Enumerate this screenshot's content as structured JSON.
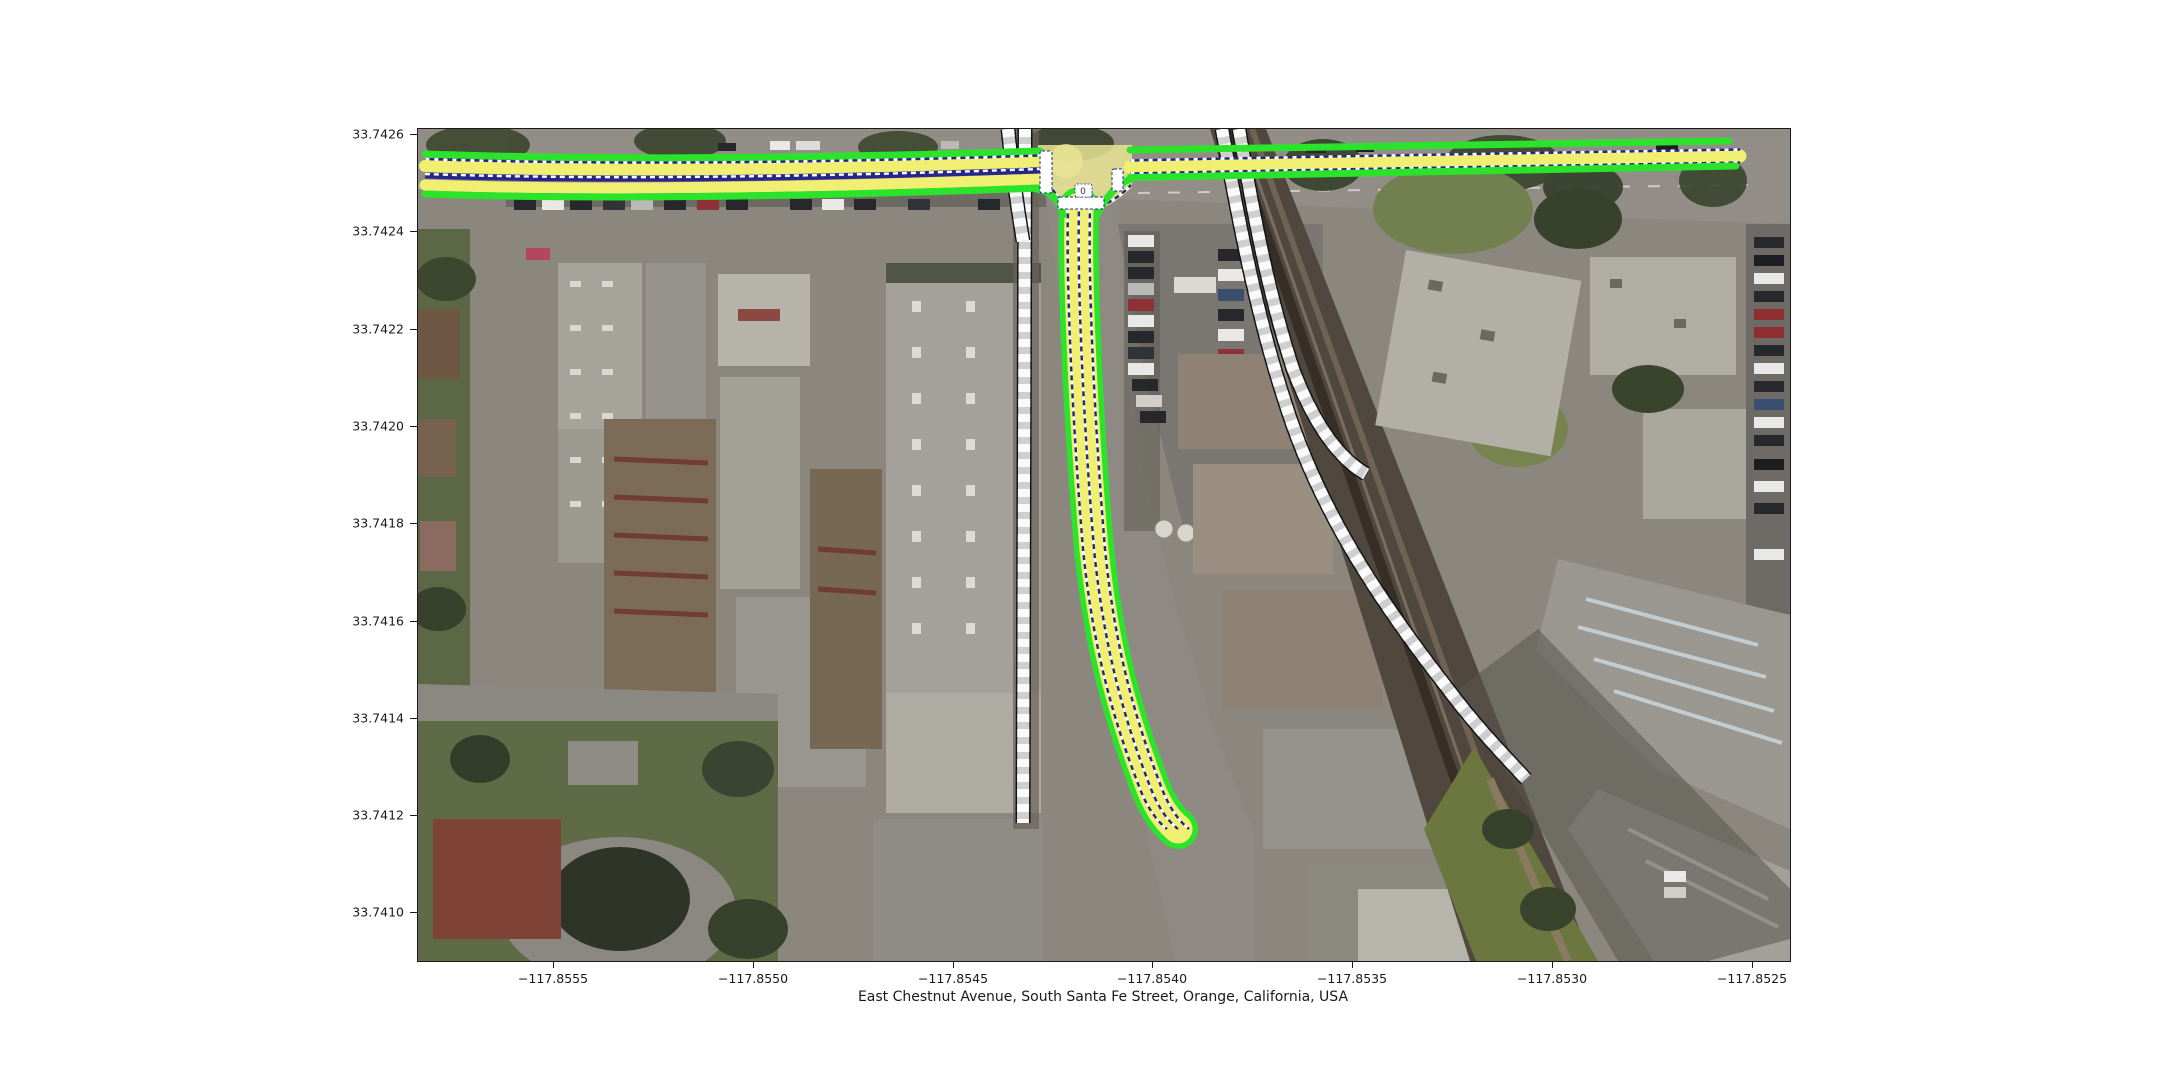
{
  "figure": {
    "background": "#ffffff",
    "xlabel": "East Chestnut Avenue, South Santa Fe Street, Orange, California, USA"
  },
  "axes": {
    "x_ticks": [
      {
        "label": "−117.8555"
      },
      {
        "label": "−117.8550"
      },
      {
        "label": "−117.8545"
      },
      {
        "label": "−117.8540"
      },
      {
        "label": "−117.8535"
      },
      {
        "label": "−117.8530"
      },
      {
        "label": "−117.8525"
      }
    ],
    "y_ticks": [
      {
        "label": "33.7426"
      },
      {
        "label": "33.7424"
      },
      {
        "label": "33.7422"
      },
      {
        "label": "33.7420"
      },
      {
        "label": "33.7418"
      },
      {
        "label": "33.7416"
      },
      {
        "label": "33.7414"
      },
      {
        "label": "33.7412"
      },
      {
        "label": "33.7410"
      }
    ]
  },
  "chart_data": {
    "type": "map",
    "title": "",
    "xlabel": "East Chestnut Avenue, South Santa Fe Street, Orange, California, USA",
    "ylabel": "",
    "x_tick_values": [
      -117.8555,
      -117.855,
      -117.8545,
      -117.854,
      -117.8535,
      -117.853,
      -117.8525
    ],
    "y_tick_values": [
      33.7426,
      33.7424,
      33.7422,
      33.742,
      33.7418,
      33.7416,
      33.7414,
      33.7412,
      33.741
    ],
    "x_range_lon": [
      -117.85584,
      -117.85241
    ],
    "y_range_lat": [
      33.7409,
      33.74261
    ],
    "grid": false,
    "legend": "none",
    "layers": [
      "aerial-imagery",
      "railway-overlay",
      "lanelet-road-overlay",
      "stop-lines"
    ],
    "features": {
      "horizontal_road": "East Chestnut Avenue, two marked lanes west of junction, one marked eastbound lane east of junction",
      "vertical_road": "South Santa Fe Street, two-lane, curves southeast and ends mid-map",
      "junction": "T-intersection with stop lines and small traffic-sign marker",
      "railways": "one vertical track pair converging south of the avenue, one double track curving southeast"
    },
    "overlay_colors": {
      "lane_fill_yellow": "#f0ef72",
      "lane_boundary_green": "#2ce32c",
      "lane_dash_navy": "#26268a",
      "dash_white": "#ffffff",
      "railway_gray": "#cfcfcf",
      "railway_outline": "#141414",
      "stop_line_white": "#ffffff",
      "junction_fill": "#e9e493"
    },
    "intersection_marker": {
      "label": "0"
    }
  }
}
